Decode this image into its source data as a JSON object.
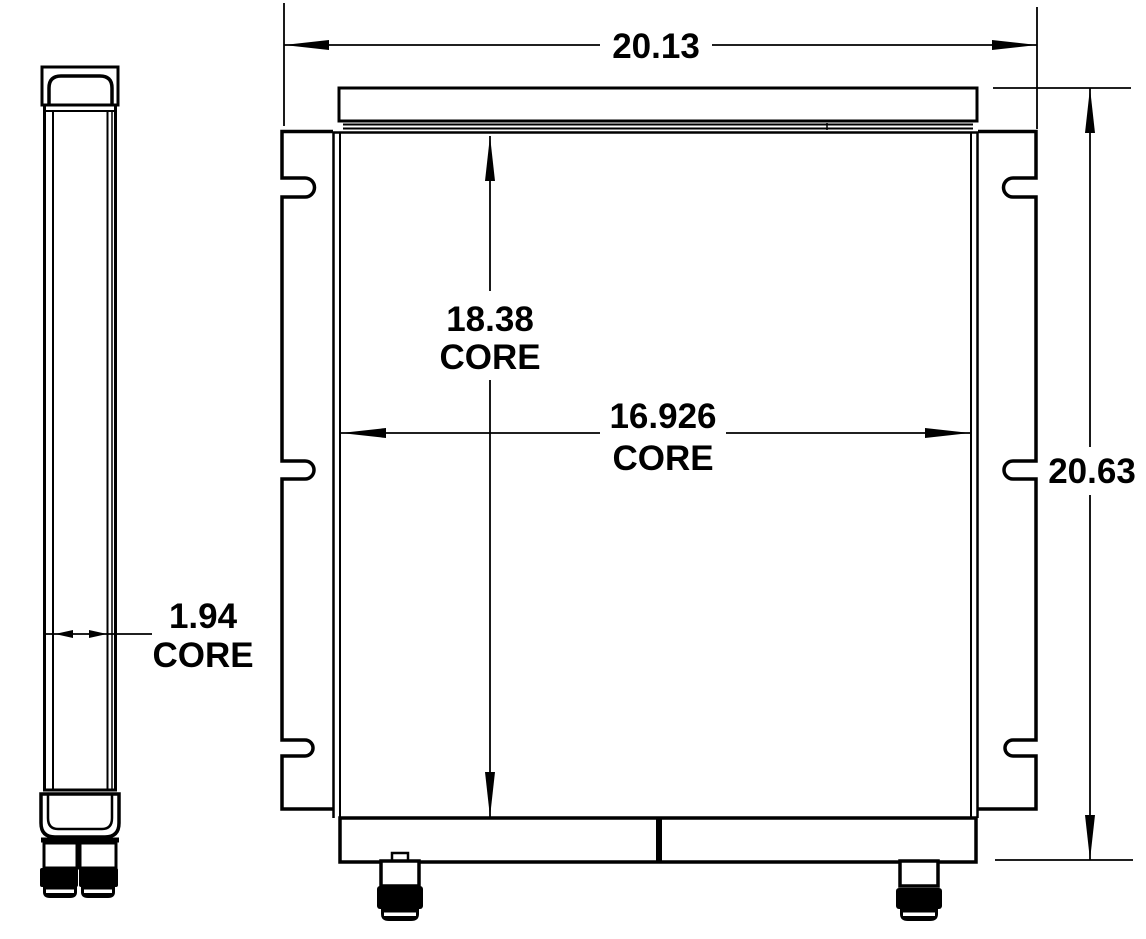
{
  "colors": {
    "line": "#000000",
    "background": "#ffffff"
  },
  "dimensions": {
    "overall_width": {
      "value": "20.13"
    },
    "overall_height": {
      "value": "20.63"
    },
    "core_height": {
      "value": "18.38",
      "suffix": "CORE"
    },
    "core_width": {
      "value": "16.926",
      "suffix": "CORE"
    },
    "core_depth": {
      "value": "1.94",
      "suffix": "CORE"
    }
  }
}
